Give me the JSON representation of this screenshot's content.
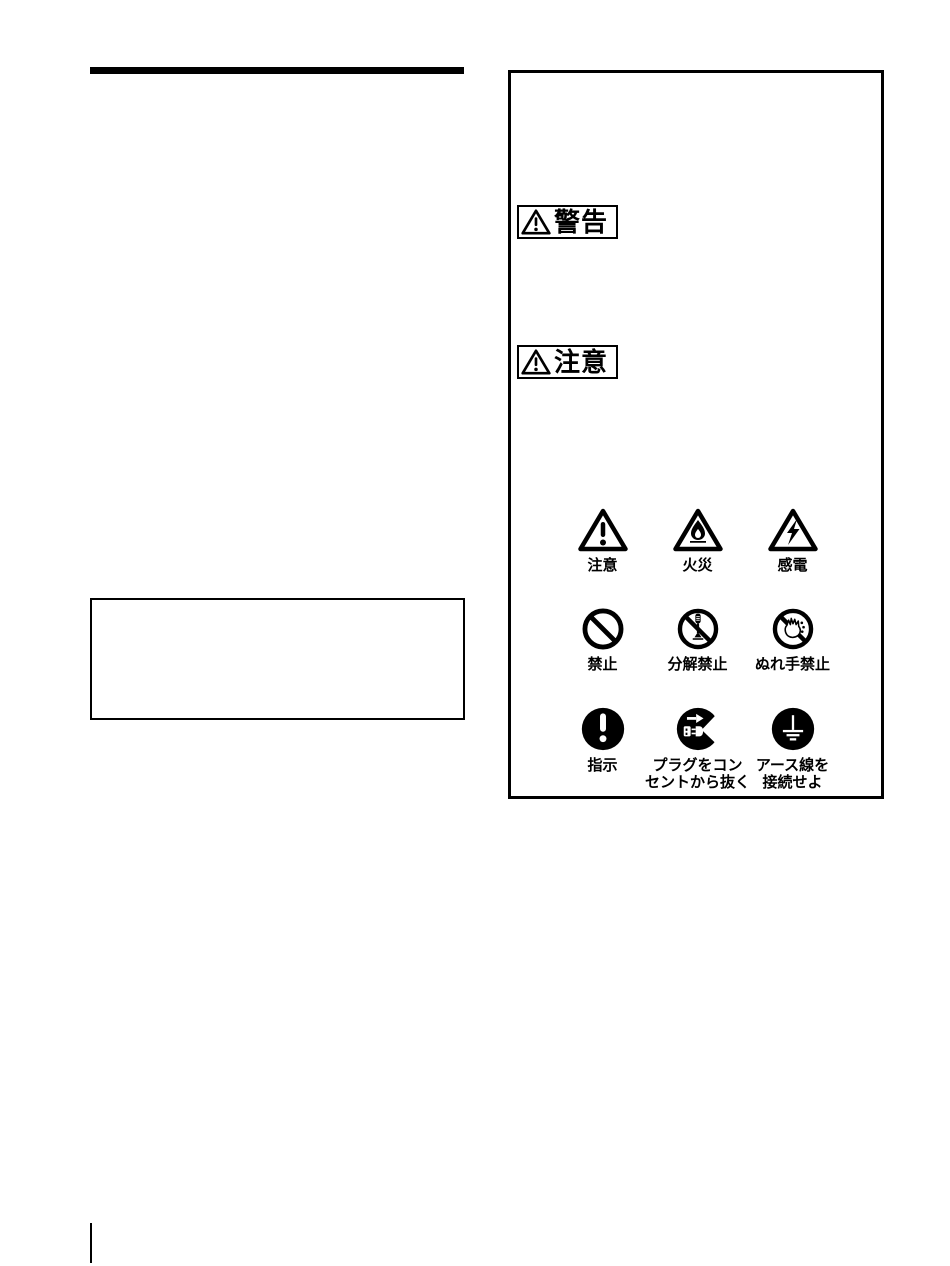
{
  "colors": {
    "ink": "#000000",
    "paper": "#ffffff"
  },
  "safety_box": {
    "warning_badge": {
      "label": "警告"
    },
    "caution_badge": {
      "label": "注意"
    },
    "symbols": [
      {
        "id": "caution",
        "label": "注意"
      },
      {
        "id": "fire",
        "label": "火災"
      },
      {
        "id": "electric-shock",
        "label": "感電"
      },
      {
        "id": "prohibited",
        "label": "禁止"
      },
      {
        "id": "disassembly-prohibited",
        "label": "分解禁止"
      },
      {
        "id": "wet-hands-prohibited",
        "label": "ぬれ手禁止"
      },
      {
        "id": "instruction",
        "label": "指示"
      },
      {
        "id": "unplug-from-outlet",
        "label": "プラグをコン\nセントから抜く"
      },
      {
        "id": "connect-ground-wire",
        "label": "アース線を\n接続せよ"
      }
    ]
  }
}
